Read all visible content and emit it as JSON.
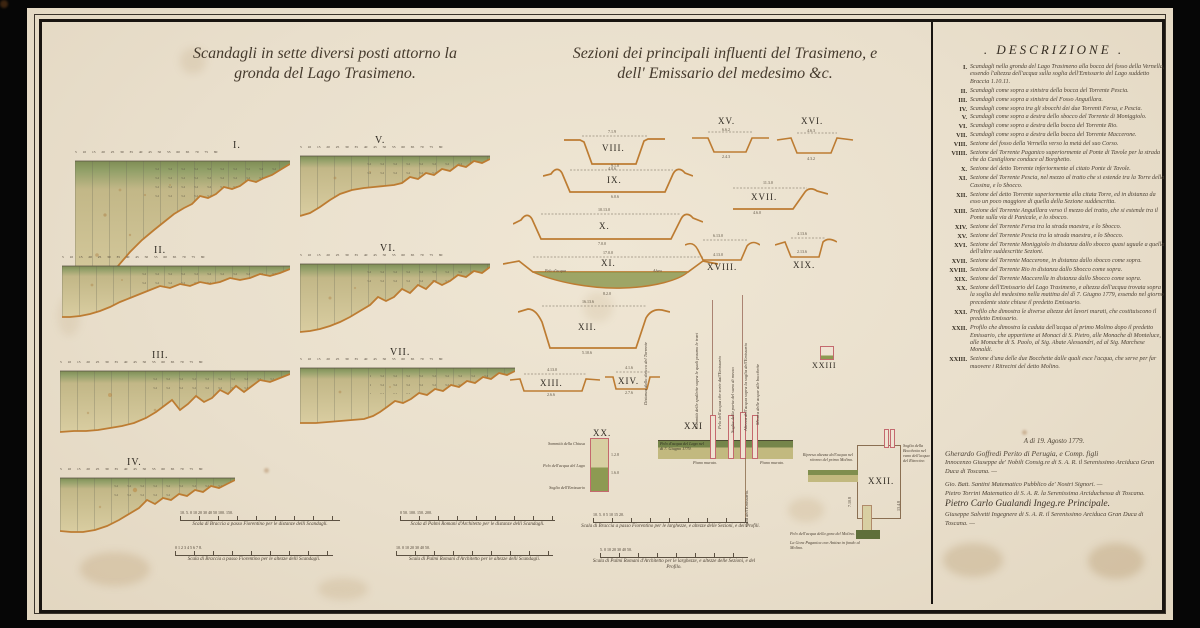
{
  "titles": {
    "left1": "Scandagli in sette diversi posti attorno la",
    "left2": "gronda del Lago Trasimeno.",
    "mid1": "Sezioni dei principali influenti del Trasimeno, e",
    "mid2": "dell' Emissario del medesimo &c."
  },
  "profiles": {
    "ticks": "5 10 15 20 25 30 35 40 45 50 55 60 65 70 75 80",
    "items": [
      {
        "label": "I."
      },
      {
        "label": "II."
      },
      {
        "label": "III."
      },
      {
        "label": "IV."
      },
      {
        "label": "V."
      },
      {
        "label": "VI."
      },
      {
        "label": "VII."
      }
    ]
  },
  "sections": {
    "items": [
      {
        "label": "VIII.",
        "t": "7.1.9",
        "b": "4.0.6"
      },
      {
        "label": "IX.",
        "t": "9.1.0",
        "b": "6.0.6"
      },
      {
        "label": "X.",
        "t": "10.13.0",
        "b": "7.0.0"
      },
      {
        "label": "XI.",
        "t": "17.0.0",
        "b": "8.2.0"
      },
      {
        "label": "XII.",
        "t": "16.13.6",
        "b": "5.10.6"
      },
      {
        "label": "XIII.",
        "t": "4.13.0",
        "b": "2.6.6"
      },
      {
        "label": "XIV.",
        "t": "4.1.6",
        "b": "2.7.6"
      },
      {
        "label": "XV.",
        "t": "4.6.3",
        "b": "2.4.3"
      },
      {
        "label": "XVI.",
        "t": "6.6.2",
        "b": "4.3.2"
      },
      {
        "label": "XVII.",
        "t": "11.3.0",
        "b": "4.6.0"
      },
      {
        "label": "XVIII.",
        "t": "6.13.0",
        "b": "4.13.0"
      },
      {
        "label": "XIX.",
        "t": "4.13.6",
        "b": "2.13.6"
      }
    ],
    "xi_w1": "Pelo d'acqua",
    "xi_w2": "Alveo"
  },
  "emissario": {
    "xx": {
      "label": "XX.",
      "left_labels": [
        "Sommità della Chiusa",
        "Pelo dell'acqua del Lago",
        "Soglia dell'Emissario"
      ],
      "n1": "1.2.8",
      "n2": "1.6.0"
    },
    "xxi": {
      "label": "XXI",
      "caption": "Pelo d'acqua del Lago nel dì 7. Giugno 1779.",
      "piano": "Piano murato.",
      "rot": [
        "Sommità delle spallette sopra le quali posano le travi",
        "Pelo dell'acqua che sorte dall'Emissario",
        "Soglia della porta del vano di mezzo",
        "Altezza dell'acqua sopra la soglia dell'Emissario",
        "Misura delle acque alle bocchette"
      ],
      "rot_below": "Gola dell'Emissario.",
      "rot_left": "Distanza dallo sbocco del Torrente"
    },
    "xxii": {
      "label": "XXII.",
      "left": "Ripresa altezza dell'acqua nel ritorno del primo Molino.",
      "right": "Soglia della Bocchetta nel vano dell'acqua del Ritrecine.",
      "b1": "Pelo dell'acqua della gora del Molino.",
      "b2": "La Gora Paganica con Antina in fondo al Molino.",
      "n1": "7.10.8",
      "n2": "13.4.8"
    },
    "xxiii": {
      "label": "XXIII"
    }
  },
  "scales": {
    "bars": [
      {
        "ticks": "10. 5. 0 10 20 30 40 50 100. 150.",
        "caption": "Scala di Braccia a passo Fiorentino per le distanze delli Scandagli."
      },
      {
        "ticks": "0 1 2 3 4 5 6 7 8.",
        "caption": "Scala di Braccia a passo Fiorentino per le altezze delli Scandagli."
      },
      {
        "ticks": "0 50. 100. 150. 200.",
        "caption": "Scala di Palmi Romani d'Architetto per le distanze delli Scandagli."
      },
      {
        "ticks": "10. 0 10 20 30 40 50.",
        "caption": "Scala di Palmi Romani d'Architetto per le altezze delli Scandagli."
      },
      {
        "ticks": "10. 5. 0 5 10 15 20.",
        "caption": "Scala di Braccia a passo Fiorentino per le larghezze, e altezze delle Sezioni, e dei Profili."
      },
      {
        "ticks": "5. 0 10 20 30 40 50.",
        "caption": "Scala di Palmi Romani d'Architetto per le larghezze, e altezze delle Sezioni, e del Profilo."
      }
    ]
  },
  "description": {
    "title": ". DESCRIZIONE .",
    "entries": [
      {
        "n": "I.",
        "t": "Scandagli nella gronda del Lago Trasimeno alla bocca del fosso della Vernella, essendo l'altezza dell'acqua sulla soglia dell'Emissario del Lago suddetto Braccia 1.10.11."
      },
      {
        "n": "II.",
        "t": "Scandagli come sopra a sinistra della bocca del Torrente Pescia."
      },
      {
        "n": "III.",
        "t": "Scandagli come sopra a sinistra del Fosso Anguillara."
      },
      {
        "n": "IV.",
        "t": "Scandagli come sopra tra gli sbocchi dei due Torrenti Fersa, e Pescia."
      },
      {
        "n": "V.",
        "t": "Scandagli come sopra a destra dello sbocco del Torrente di Moniggiolo."
      },
      {
        "n": "VI.",
        "t": "Scandagli come sopra a destra della bocca del Torrente Rio."
      },
      {
        "n": "VII.",
        "t": "Scandagli come sopra a destra della bocca del Torrente Maccerone."
      },
      {
        "n": "VIII.",
        "t": "Sezione del fosso della Vernella verso la metà del suo Corso."
      },
      {
        "n": "VIIII.",
        "t": "Sezione del Torrente Paganico superiormente al Ponte di Tavole per la strada che da Castiglione conduce al Borghetto."
      },
      {
        "n": "X.",
        "t": "Sezione del detto Torrente inferiormente al citato Ponte di Tavole."
      },
      {
        "n": "XI.",
        "t": "Sezione del Torrente Pescia, nel mezzo al tratto che si estende tra la Torre della Cassina, e lo Sbocco."
      },
      {
        "n": "XII.",
        "t": "Sezione del detto Torrente superiormente alla citata Torre, ed in distanza da esso un poco maggiore di quella della Sezione suddescritta."
      },
      {
        "n": "XIII.",
        "t": "Sezione del Torrente Anguillara verso il mezzo del tratto, che si estende tra il Ponte sulla via di Panicale, e lo sbocco."
      },
      {
        "n": "XIV.",
        "t": "Sezione del Torrente Fersa tra la strada maestra, e lo Sbocco."
      },
      {
        "n": "XV.",
        "t": "Sezione del Torrente Pescia tra la strada maestra, e lo Sbocco."
      },
      {
        "n": "XVI.",
        "t": "Sezione del Torrente Moniggiolo in distanza dallo sbocco quasi uguale a quella dell'altre suddescritte Sezioni."
      },
      {
        "n": "XVII.",
        "t": "Sezione del Torrente Maccerone, in distanza dallo sbocco come sopra."
      },
      {
        "n": "XVIII.",
        "t": "Sezione del Torrente Rio in distanza dallo Sbocco come sopra."
      },
      {
        "n": "XIX.",
        "t": "Sezione del Torrente Maccerella in distanza dallo Sbocco come sopra."
      },
      {
        "n": "XX.",
        "t": "Sezione dell'Emissario del Lago Trasimeno, e altezza dell'acqua trovata sopra la soglia del medesimo nella mattina del dì 7. Giugno 1779, essendo nel giorno precedente state chiuse il predetto Emissario."
      },
      {
        "n": "XXI.",
        "t": "Profilo che dimostra le diverse altezze dei lavori murati, che costituiscono il predetto Emissario."
      },
      {
        "n": "XXII.",
        "t": "Profilo che dimostra la caduta dell'acqua al primo Molino dopo il predetto Emissario, che appartiene ai Monaci di S. Pietro, alle Monache di Monteluce, alle Monache di S. Paolo, al Sig. Abate Alessandri, ed al Sig. Marchese Monaldi."
      },
      {
        "n": "XXIII.",
        "t": "Sezione d'una delle due Bocchette dalle quali esce l'acqua, che serve per far muovere i Ritrecini del detto Molino."
      }
    ]
  },
  "signatures": {
    "date": "A dì 19. Agosto 1779.",
    "lines": [
      "Gherardo Goffredi Perito di Perugia, e Comp. figli",
      "Innocenzo Giuseppe de' Nobili Consig.re di S. A. R. il Serenissimo Arciduca Gran Duca di Toscana. —",
      "Gio. Batt. Santini Matematico Pubblico de' Nostri Signori. —",
      "Pietro Torrini Matematico di S. A. R. la Serenissima Arciduchessa di Toscana.",
      "Pietro Carlo Gualandi Ingeg.re Principale.",
      "Giuseppe Salvetti Ingegnere di S. A. R. il Serenissimo Arciduca Gran Duca di Toscana. —"
    ]
  }
}
